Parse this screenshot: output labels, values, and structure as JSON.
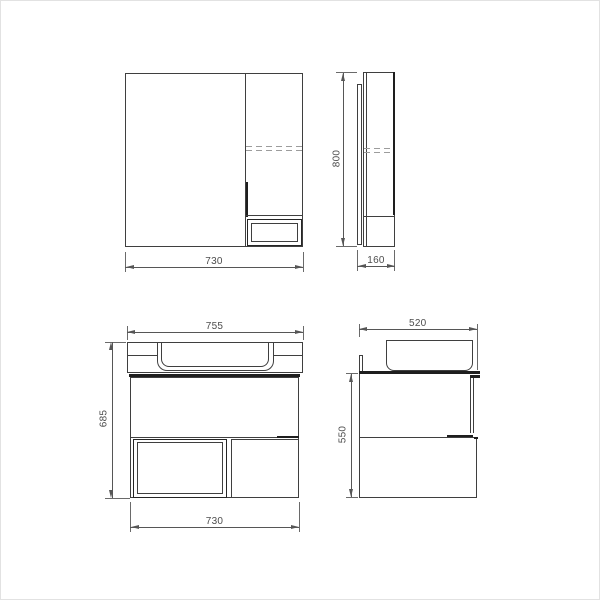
{
  "colors": {
    "background": "#ffffff",
    "outline": "#3f3f3f",
    "thick_line": "#1e1e1e",
    "dashed_line": "#9c9c9c",
    "dimension": "#565656",
    "dimension_text": "#4d4d4d",
    "frame_border": "#e2e2e2"
  },
  "views": {
    "mirror_front": {
      "width": "730"
    },
    "mirror_side": {
      "height": "800",
      "depth": "160"
    },
    "vanity_front": {
      "top_width": "755",
      "height": "685",
      "bottom_width": "730"
    },
    "vanity_side": {
      "depth": "520",
      "height": "550"
    }
  }
}
